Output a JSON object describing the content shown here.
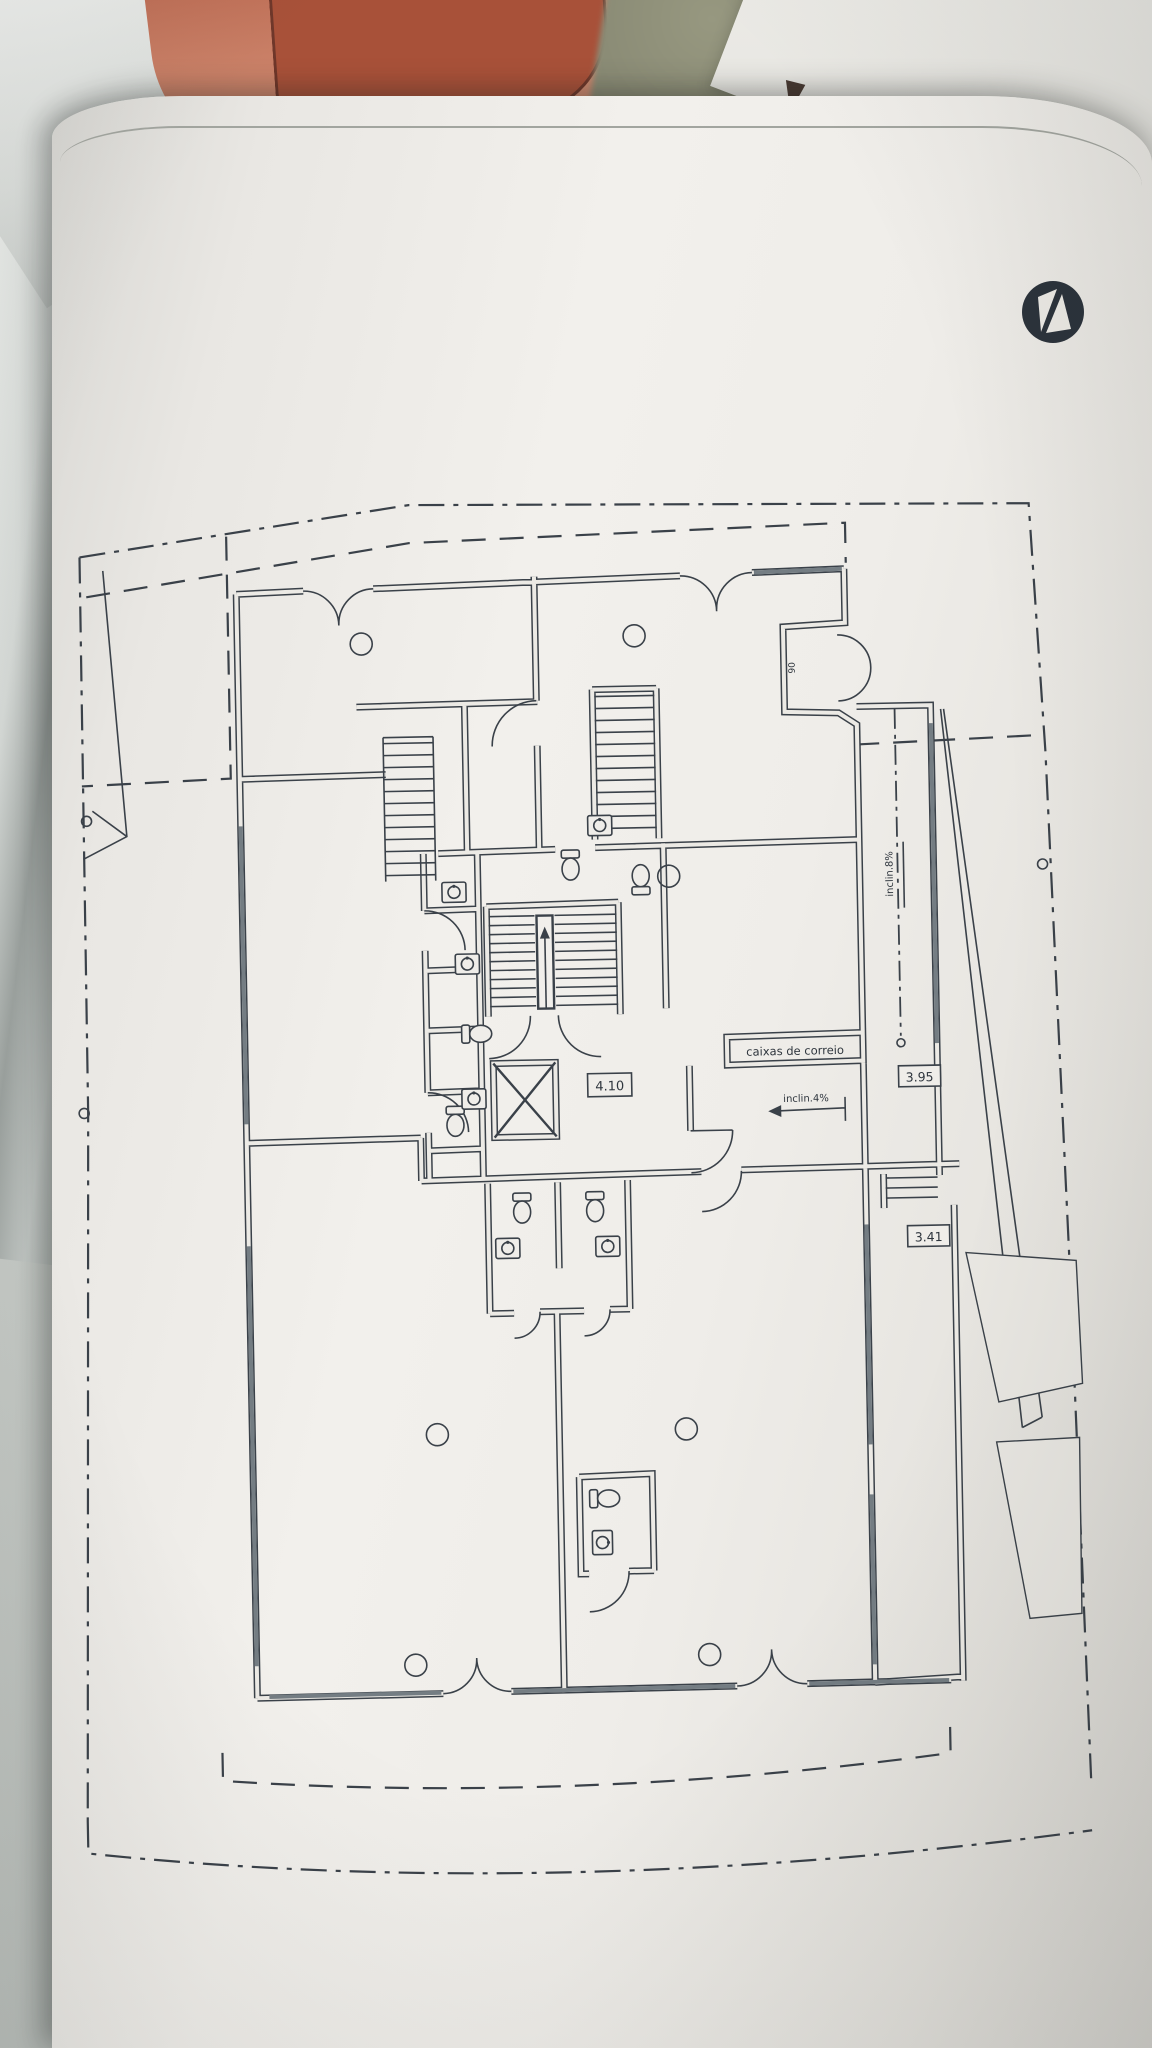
{
  "photo": {
    "handwritten_note": "25"
  },
  "plan": {
    "ink_color": "#3a4149",
    "paper_color": "#efede9",
    "labels": {
      "mailboxes": "caixas de correio",
      "hall_width": "4.10",
      "ramp_width_upper": "3.95",
      "ramp_width_lower": "3.41",
      "ramp_slope": "inclin.4%",
      "side_slope": "inclin.8%",
      "entry_door_width": "90"
    }
  }
}
